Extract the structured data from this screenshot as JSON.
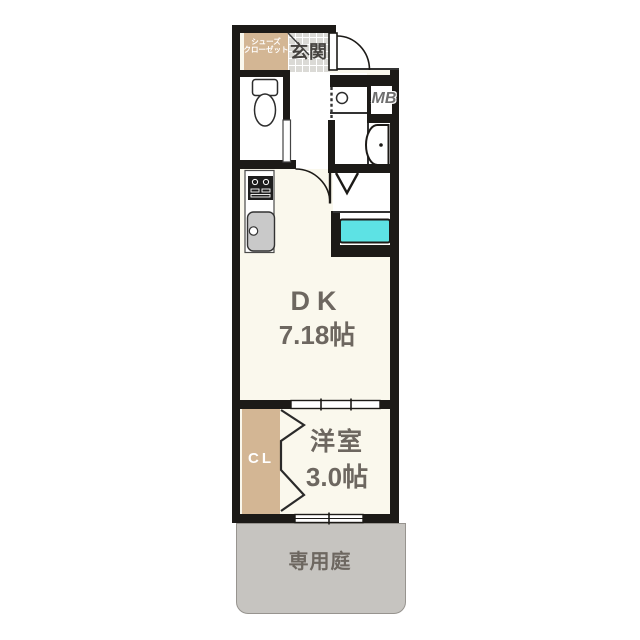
{
  "floorplan": {
    "rooms": {
      "genkan": {
        "label": "玄関"
      },
      "shoe_closet": {
        "line1": "シューズ",
        "line2": "クローゼット"
      },
      "meter_box": {
        "label": "MB"
      },
      "dk": {
        "name": "DK",
        "size": "7.18帖"
      },
      "western_room": {
        "name": "洋室",
        "size": "3.0帖"
      },
      "closet": {
        "label": "CL"
      },
      "private_garden": {
        "label": "専用庭"
      }
    },
    "colors": {
      "wall": "#1c1a17",
      "room_floor": "#faf8ed",
      "closet_tan": "#d3b694",
      "entry_tile": "#dbdad6",
      "garden_gray": "#c6c4c0",
      "washer_pan_cyan": "#5de2e4",
      "label_text": "#6d6760"
    }
  }
}
